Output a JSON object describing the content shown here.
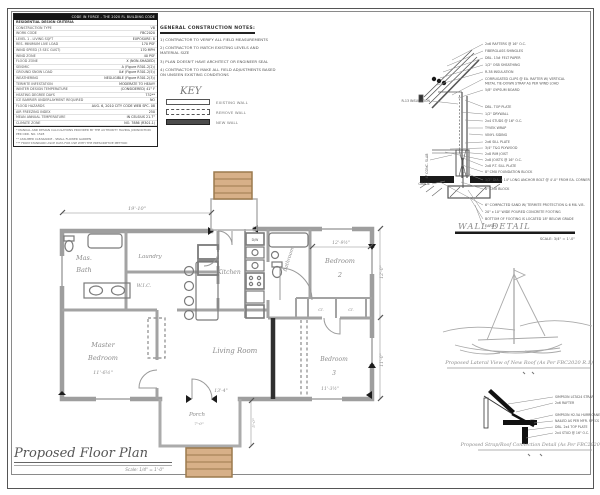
{
  "spec_table": {
    "header_right": "CODE IN FORCE - THE 2020 FL BUILDING CODE",
    "rows": [
      {
        "label": "RESIDENTIAL DESIGN CRITERIA",
        "value": ""
      },
      {
        "label": "CONSTRUCTION TYPE",
        "value": "VB"
      },
      {
        "label": "WORK CODE",
        "value": "FBC2020"
      },
      {
        "label": "LEVEL 1 - LIVING SQFT",
        "value": "EXPOSURE: B"
      },
      {
        "label": "RES. MINIMUM LIVE LOAD",
        "value": "170 PSF"
      },
      {
        "label": "WIND SPEED (3 SEC GUST)",
        "value": "170 MPH"
      },
      {
        "label": "WIND ZONE",
        "value": "40 PSF"
      },
      {
        "label": "FLOOD ZONE",
        "value": "X (NON-SHADED)"
      },
      {
        "label": "SEISMIC",
        "value": "A (Figure R301.2(2))"
      },
      {
        "label": "GROUND SNOW LOAD",
        "value": "0# (Figure R301.2(5))"
      },
      {
        "label": "WEATHERING",
        "value": "NEGLIGIBLE (Figure R301.2(3))"
      },
      {
        "label": "TERMITE INFESTATION",
        "value": "MODERATE TO HEAVY"
      },
      {
        "label": "WINTER DESIGN TEMPERATURE",
        "value": "(CONSIDERED) 41° F"
      },
      {
        "label": "HEATING DEGREE DAYS",
        "value": "732**"
      },
      {
        "label": "ICE BARRIER UNDERLAYMENT REQUIRED",
        "value": "NO"
      },
      {
        "label": "FLOOD HAZARDS",
        "value": "AUG. 6, 2010 CITY CODE WEB SPC. 08"
      },
      {
        "label": "AIR FREEZING INDEX",
        "value": "250"
      },
      {
        "label": "MEAN ANNUAL TEMPERATURE",
        "value": "IN CELSIUS 21.7°"
      },
      {
        "label": "CLIMATE ZONE",
        "value": "NO. 7886 (R301.1)"
      }
    ],
    "notes": [
      "* MANUAL AND DESIGN CALCULATIONS PROVIDED BY THE AUTHORITY HAVING JURISDICTION PER ORD. NO. 1528",
      "** ASSUMED CLEARANCE - SMALL FLOWER GARDEN",
      "*** FROM STANDARD ASCE DATA FOR USE WITH THE PRESCRIPTIVE METHOD"
    ]
  },
  "general_notes": {
    "title": "GENERAL CONSTRUCTION NOTES:",
    "items": [
      "1)  CONTRACTOR TO VERIFY ALL FIELD MEASUREMENTS",
      "2)  CONTRACTOR TO MATCH EXISTING LEVELS AND MATERIAL SIZE",
      "3)  PLAN DOESN'T HAVE ARCHITECT OR ENGINEER SEAL",
      "4)  CONTRACTOR TO MAKE ALL FIELD ADJUSTMENTS BASED ON UNSEEN EXISTING CONDITIONS"
    ]
  },
  "key": {
    "title": "KEY",
    "existing": "EXISTING WALL",
    "remove": "REMOVE WALL",
    "new": "NEW WALL"
  },
  "wall_detail": {
    "title": "WALL DETAIL",
    "scale": "SCALE: 3/4\" = 1'-0\"",
    "labels": [
      "2x6 RAFTERS @ 16\" O.C.",
      "FIBERGLASS SHINGLES",
      "DBL. 15# FELT PAPER",
      "1/2\" OSB SHEATHING",
      "R-38 INSULATION",
      "CORRUGATED CLIPS @ EA. RAFTER W/ VERTICAL",
      "METAL TIE-DOWN STRAP AS PER WIND LOAD",
      "5/8\" GYPSUM BOARD",
      "DBL. TOP PLATE",
      "1/2\" DRYWALL",
      "2x4 STUDS @ 16\" O.C.",
      "TYVEK WRAP",
      "VINYL SIDING",
      "2x6 SILL PLATE",
      "3/4\" T&G PLYWOOD",
      "2x8 RIM JOIST",
      "2x8 JOISTS @ 16\" O.C.",
      "2x8 P.T. SILL PLATE",
      "8\" CMU FOUNDATION BLOCK",
      "1/2\" DIA. x 14\" LONG ANCHOR BOLT @ 4'-0\" FROM EA. CORNER",
      "8\" CMU BLOCK",
      "6\" COMPACTED SAND W/ TERMITE PROTECTION & 6 MIL V.B.",
      "20\" x 10\" WIDE POURED CONCRETE FOOTING",
      "BOTTOM OF FOOTING IS LOCATED 18\" BELOW GRADE",
      "EARTH"
    ],
    "left_labels": [
      "R-13 INSULATION",
      "4\" CONC. SLAB",
      "GRADE"
    ]
  },
  "lateral_sketch": {
    "caption": "Proposed Lateral View of New Roof (As Per FBC2020 R.1)"
  },
  "strap_detail": {
    "caption": "Proposed Strap/Roof Connection Detail (As Per FBC2020 R.1)",
    "labels": [
      "SIMPSON LSTA24 STRAP",
      "2x6 RAFTER",
      "SIMPSON H2.5A HURRICANE CLIP",
      "NAILED AS PER MFR. SPECS",
      "DBL. 2x4 TOP PLATE",
      "2x4 STUD @ 16\" O.C."
    ]
  },
  "floor_plan": {
    "title": "Proposed Floor Plan",
    "scale": "Scale: 1/4\" = 1'-0\"",
    "rooms": {
      "mas_bath_1": "Mas.",
      "mas_bath_2": "Bath",
      "laundry": "Laundry",
      "wic": "W.I.C.",
      "kitchen": "Kitchen",
      "bathroom": "Bathroom",
      "bedroom2_1": "Bedroom",
      "bedroom2_2": "2",
      "master_1": "Master",
      "master_2": "Bedroom",
      "living": "Living Room",
      "bedroom3_1": "Bedroom",
      "bedroom3_2": "3",
      "porch": "Porch",
      "closet1": "Cl.",
      "closet2": "Cl.",
      "dishwasher": "D/W"
    },
    "dims": {
      "top": "19'-10\"",
      "bedroom2": "12'-9½\"",
      "master": "11'-6½\"",
      "living": "13'-4\"",
      "bedroom3": "11'-3½\"",
      "right_top": "12'-0\"",
      "right_bottom": "11'-0\"",
      "porch": "7'-0\"",
      "porch_side": "5'-0\""
    },
    "colors": {
      "wall_gray": "#9e9e9e",
      "new_wall": "#2f2f2f",
      "steps_tan": "#d7b088",
      "steps_border": "#9c7a4e"
    }
  }
}
